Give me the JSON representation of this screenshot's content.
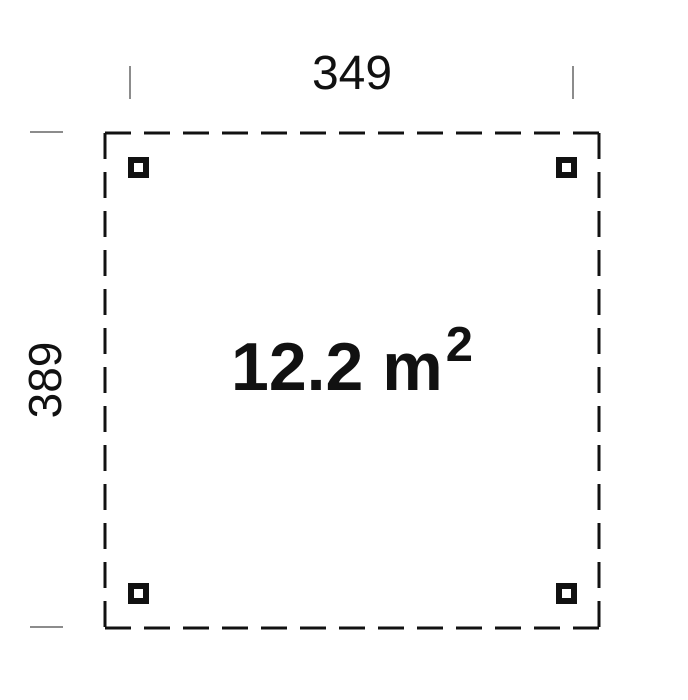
{
  "plan": {
    "width_label": "349",
    "height_label": "389",
    "area_value": "12.2 m",
    "area_exponent": "2"
  },
  "colors": {
    "bg": "#ffffff",
    "line": "#111111",
    "tick": "#8c8c8c",
    "text": "#111111"
  }
}
